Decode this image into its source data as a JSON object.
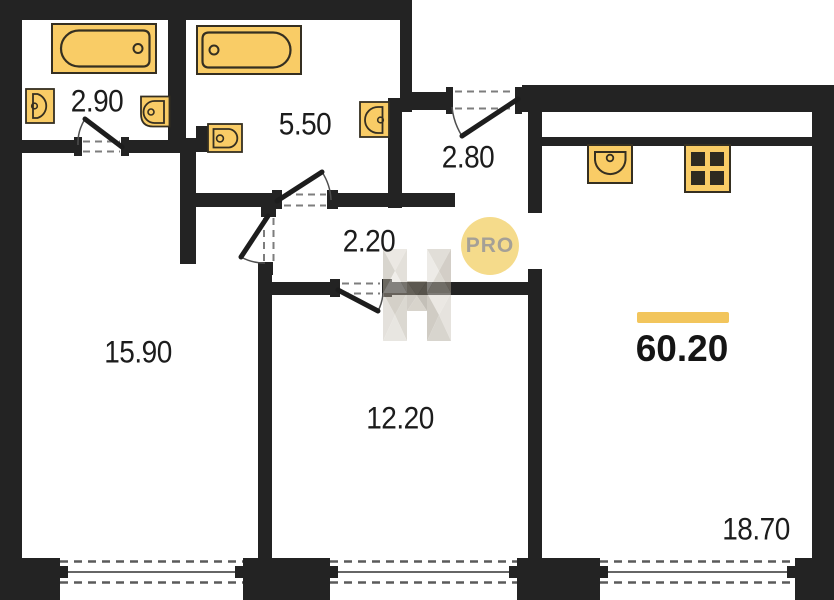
{
  "title": "apartment-floor-plan",
  "rooms": [
    {
      "name": "bathroom-small",
      "area": "2.90"
    },
    {
      "name": "bathroom-large",
      "area": "5.50"
    },
    {
      "name": "entrance-hall",
      "area": "2.80"
    },
    {
      "name": "corridor",
      "area": "2.20"
    },
    {
      "name": "room-left",
      "area": "15.90"
    },
    {
      "name": "room-middle",
      "area": "12.20"
    },
    {
      "name": "kitchen-living-room",
      "area": "18.70"
    }
  ],
  "total_area": "60.20",
  "badge": {
    "label": "PRO"
  },
  "colors": {
    "wall": "#232323",
    "fixture_fill": "#F9CC66",
    "fixture_outline": "#352F21",
    "accent_bar": "#F2C55C",
    "badge_bg": "#F5DB8B",
    "badge_text": "#A5A096",
    "dash": "#7D7D7D",
    "watermark_tone": "#B7B0A3"
  },
  "fixtures": [
    "bathtub-icon",
    "toilet-icon",
    "sink-icon",
    "kitchen-sink-icon",
    "stove-4-burner-icon",
    "door-swing-icon",
    "window-icon"
  ]
}
